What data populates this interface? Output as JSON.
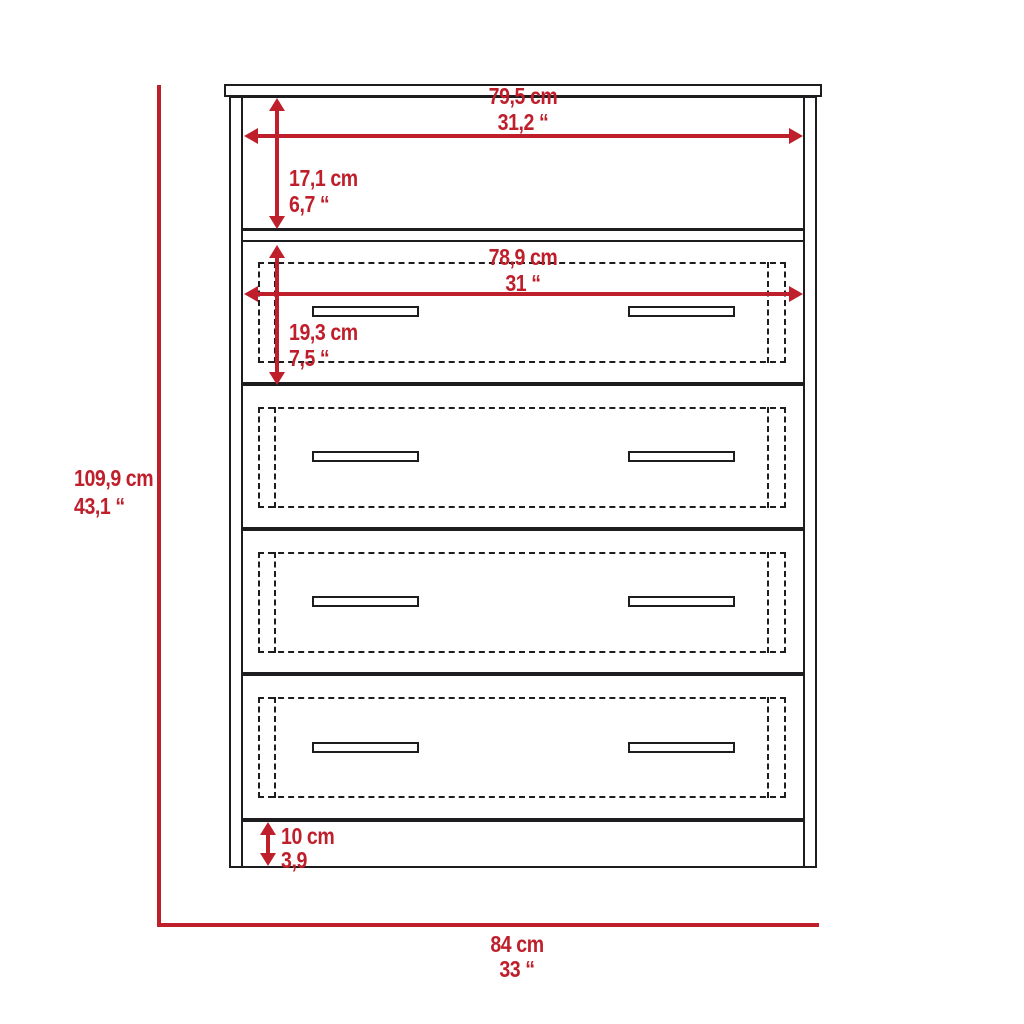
{
  "diagram": {
    "title": "4-drawer dresser with open shelf — dimension drawing",
    "accent_color": "#bf1f2b",
    "line_color": "#1d1d1f",
    "drawer_count": 4,
    "dimensions": {
      "overall_height": {
        "cm": "109,9 cm",
        "in": "43,1 “"
      },
      "overall_width": {
        "cm": "84 cm",
        "in": "33 “"
      },
      "shelf_width": {
        "cm": "79,5 cm",
        "in": "31,2 “"
      },
      "shelf_height": {
        "cm": "17,1 cm",
        "in": "6,7 “"
      },
      "drawer_width": {
        "cm": "78,9 cm",
        "in": "31 “"
      },
      "drawer_height": {
        "cm": "19,3 cm",
        "in": "7,5 “"
      },
      "base_height": {
        "cm": "10 cm",
        "in": "3,9"
      }
    }
  }
}
